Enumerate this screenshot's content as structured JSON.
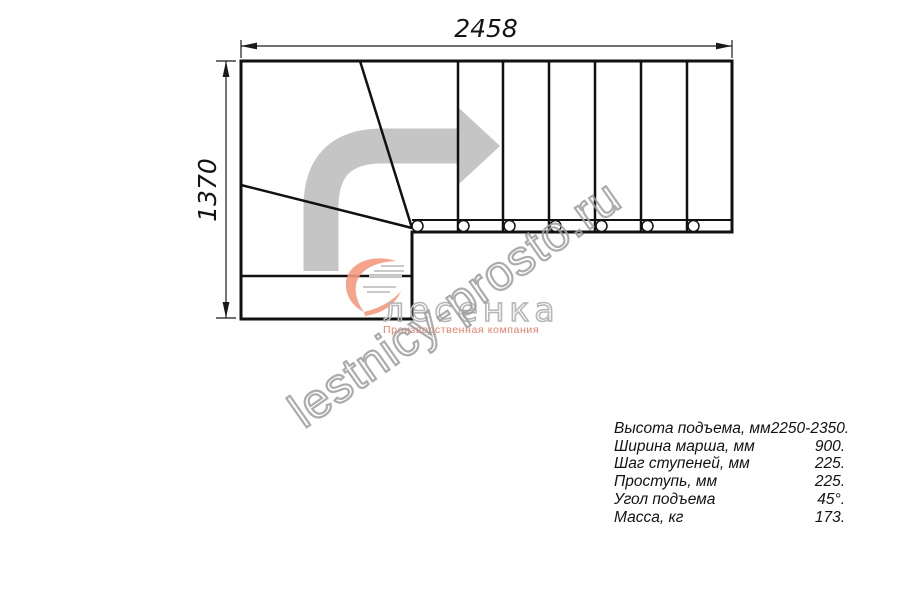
{
  "drawing": {
    "type": "staircase-floor-plan",
    "width_label": "2458",
    "height_label": "1370",
    "line_color": "#111111",
    "direction_arrow_color": "#c5c5c5",
    "straight_steps": 6,
    "baluster_count": 7,
    "winder_steps": 3
  },
  "watermark": {
    "text": "lestnicy-prosto.ru",
    "color": "#9e9e9e"
  },
  "logo": {
    "brand": "лесенка",
    "tagline": "Производственная компания",
    "accent_color": "#f4997d",
    "tagline_color": "#ee7f66"
  },
  "specs": {
    "rows": [
      {
        "label": "Высота подъема, мм",
        "value": "2250-2350."
      },
      {
        "label": "Ширина марша, мм",
        "value": "900."
      },
      {
        "label": "Шаг ступеней, мм",
        "value": "225."
      },
      {
        "label": "Проступь, мм",
        "value": "225."
      },
      {
        "label": "Угол подъема",
        "value": "45°."
      },
      {
        "label": "Масса, кг",
        "value": "173."
      }
    ]
  }
}
